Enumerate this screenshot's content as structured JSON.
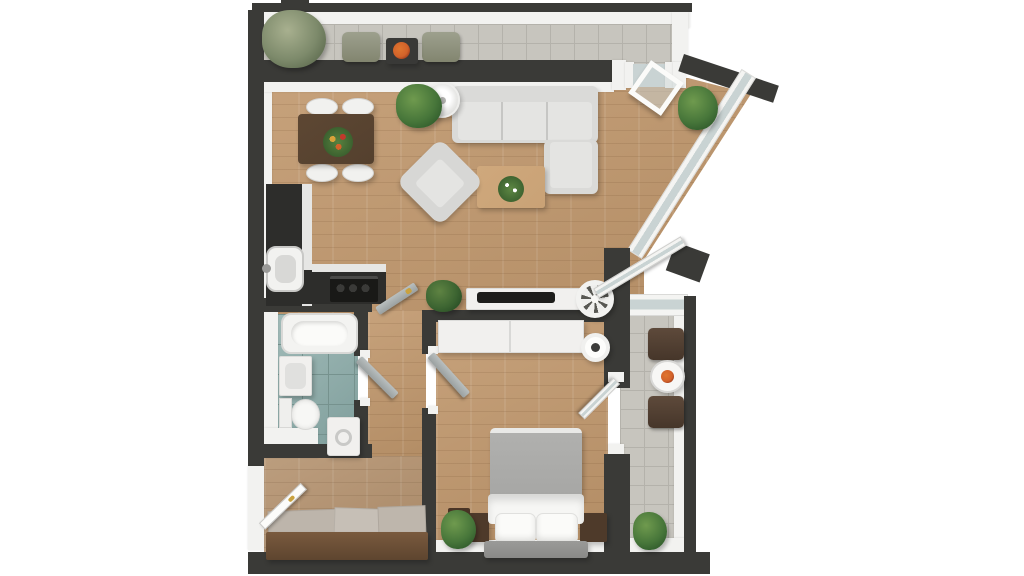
{
  "scene": {
    "kind": "3d-apartment-floor-plan-render",
    "view": "top-down",
    "width_px": 1024,
    "height_px": 576,
    "background": "#ffffff"
  },
  "palette": {
    "wall": "#3a3a37",
    "wall-inner": "#f2f2f0",
    "floor-wood": "#c0976c",
    "balcony-tile": "#c7c5be",
    "balcony-grout": "#b4b2ab",
    "bath-tile": "#87a8a5",
    "bath-grout": "#76928e",
    "sofa-gray": "#dadad8",
    "bed-duvet": "#a6a6a4",
    "furniture-white": "#f1f0ee",
    "wood-brown-dark": "#54402e",
    "coffee-table": "#c9a276",
    "door-gray": "#9aa0a0",
    "glass": "#c9d3d3",
    "plant-light": "#6f9a4e",
    "plant-green": "#47763a",
    "plant-dark": "#2f5a2b",
    "flower-orange": "#d2622a",
    "handle-gold": "#c9a23f"
  },
  "floor_plan": {
    "rooms": [
      {
        "name": "top-balcony",
        "floor": "gray-tile",
        "contents": [
          "potted-plant",
          "chair",
          "chair",
          "bistro-table-with-flowers"
        ]
      },
      {
        "name": "living-room-with-open-kitchen",
        "floor": "wood",
        "contents": [
          "dining-table-with-flowers",
          "four-white-chairs",
          "potted-plant",
          "floor-lamp",
          "l-shaped-sofa",
          "armchair",
          "coffee-table-with-plant",
          "kitchen-counter",
          "sink",
          "cooktop",
          "tv-sideboard",
          "tv",
          "fan",
          "potted-plant"
        ]
      },
      {
        "name": "bathroom",
        "floor": "teal-tile",
        "contents": [
          "bathtub",
          "washbasin",
          "toilet",
          "washing-machine"
        ]
      },
      {
        "name": "hallway-and-entry",
        "floor": "wood",
        "contents": [
          "doormats",
          "shoe-cabinet",
          "entrance-door"
        ]
      },
      {
        "name": "bedroom",
        "floor": "wood",
        "contents": [
          "wardrobe",
          "double-bed",
          "two-pillows",
          "nightstand",
          "nightstand",
          "round-lamp",
          "potted-plant"
        ]
      },
      {
        "name": "right-balcony",
        "floor": "gray-tile",
        "contents": [
          "chair",
          "round-table-with-flowers",
          "chair",
          "potted-plant"
        ]
      }
    ],
    "openings": [
      "entrance-door-open",
      "bathroom-door-open",
      "bedroom-door-open",
      "living-room-to-hall-door-open",
      "bedroom-balcony-door-open",
      "living-room-balcony-glazed-door-open",
      "tilted-open-window",
      "diagonal-window-wall"
    ]
  }
}
